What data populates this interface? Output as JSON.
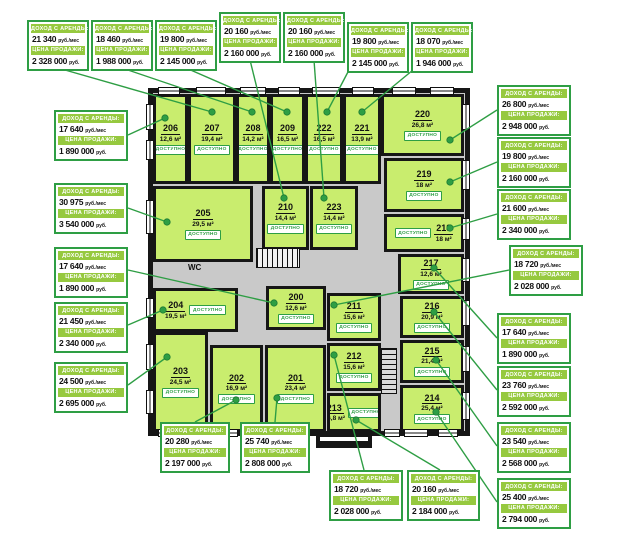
{
  "labels": {
    "income_label": "ДОХОД С АРЕНДЫ:",
    "price_label": "ЦЕНА ПРОДАЖИ:",
    "income_suffix": "руб./мес",
    "price_suffix": "руб.",
    "wc": "WC"
  },
  "colors": {
    "accent_green": "#2e9e44",
    "strip_green": "#96c93f",
    "room_fill": "#c9ed6e",
    "corridor_gray": "#c9c9c9",
    "wall_black": "#161616"
  },
  "rooms": [
    {
      "number": "200",
      "area": "12,6 м²",
      "status": "ДОСТУПНО"
    },
    {
      "number": "201",
      "area": "23,4 м²",
      "status": "ДОСТУПНО"
    },
    {
      "number": "202",
      "area": "16,9 м²",
      "status": "ДОСТУПНО"
    },
    {
      "number": "203",
      "area": "24,5 м²",
      "status": "ДОСТУПНО"
    },
    {
      "number": "204",
      "area": "19,5 м²",
      "status": "ДОСТУПНО"
    },
    {
      "number": "205",
      "area": "29,5 м²",
      "status": "ДОСТУПНО"
    },
    {
      "number": "206",
      "area": "12,6 м²",
      "status": "ДОСТУПНО"
    },
    {
      "number": "207",
      "area": "19,4 м²",
      "status": "ДОСТУПНО"
    },
    {
      "number": "208",
      "area": "14,2 м²",
      "status": "ДОСТУПНО"
    },
    {
      "number": "209",
      "area": "16,5 м²",
      "status": "ДОСТУПНО"
    },
    {
      "number": "210",
      "area": "14,4 м²",
      "status": "ДОСТУПНО"
    },
    {
      "number": "211",
      "area": "15,6 м²",
      "status": "ДОСТУПНО"
    },
    {
      "number": "212",
      "area": "15,6 м²",
      "status": "ДОСТУПНО"
    },
    {
      "number": "213",
      "area": "16,8 м²",
      "status": "ДОСТУПНО"
    },
    {
      "number": "214",
      "area": "25,4 м²",
      "status": "ДОСТУПНО"
    },
    {
      "number": "215",
      "area": "21,4 м²",
      "status": "ДОСТУПНО"
    },
    {
      "number": "216",
      "area": "20,9 м²",
      "status": "ДОСТУПНО"
    },
    {
      "number": "217",
      "area": "12,6 м²",
      "status": "ДОСТУПНО"
    },
    {
      "number": "218",
      "area": "18 м²",
      "status": "ДОСТУПНО"
    },
    {
      "number": "219",
      "area": "18 м²",
      "status": "ДОСТУПНО"
    },
    {
      "number": "220",
      "area": "26,8 м²",
      "status": "ДОСТУПНО"
    },
    {
      "number": "221",
      "area": "13,9 м²",
      "status": "ДОСТУПНО"
    },
    {
      "number": "222",
      "area": "16,5 м²",
      "status": "ДОСТУПНО"
    },
    {
      "number": "223",
      "area": "14,4 м²",
      "status": "ДОСТУПНО"
    }
  ],
  "callouts": [
    {
      "room": "207",
      "income": "21 340",
      "price": "2 328 000"
    },
    {
      "room": "208",
      "income": "18 460",
      "price": "1 988 000"
    },
    {
      "room": "209",
      "income": "19 800",
      "price": "2 145 000"
    },
    {
      "room": "210",
      "income": "20 160",
      "price": "2 160 000"
    },
    {
      "room": "223",
      "income": "20 160",
      "price": "2 160 000"
    },
    {
      "room": "222",
      "income": "19 800",
      "price": "2 145 000"
    },
    {
      "room": "221",
      "income": "18 070",
      "price": "1 946 000"
    },
    {
      "room": "220",
      "income": "26 800",
      "price": "2 948 000"
    },
    {
      "room": "219",
      "income": "19 800",
      "price": "2 160 000"
    },
    {
      "room": "218",
      "income": "21 600",
      "price": "2 340 000"
    },
    {
      "room": "211",
      "income": "18 720",
      "price": "2 028 000"
    },
    {
      "room": "217",
      "income": "17 640",
      "price": "1 890 000"
    },
    {
      "room": "216",
      "income": "23 760",
      "price": "2 592 000"
    },
    {
      "room": "215",
      "income": "23 540",
      "price": "2 568 000"
    },
    {
      "room": "214",
      "income": "25 400",
      "price": "2 794 000"
    },
    {
      "room": "206",
      "income": "17 640",
      "price": "1 890 000"
    },
    {
      "room": "205",
      "income": "30 975",
      "price": "3 540 000"
    },
    {
      "room": "200",
      "income": "17 640",
      "price": "1 890 000"
    },
    {
      "room": "204",
      "income": "21 450",
      "price": "2 340 000"
    },
    {
      "room": "203",
      "income": "24 500",
      "price": "2 695 000"
    },
    {
      "room": "202",
      "income": "20 280",
      "price": "2 197 000"
    },
    {
      "room": "201",
      "income": "25 740",
      "price": "2 808 000"
    },
    {
      "room": "212",
      "income": "18 720",
      "price": "2 028 000"
    },
    {
      "room": "213",
      "income": "20 160",
      "price": "2 184 000"
    }
  ]
}
